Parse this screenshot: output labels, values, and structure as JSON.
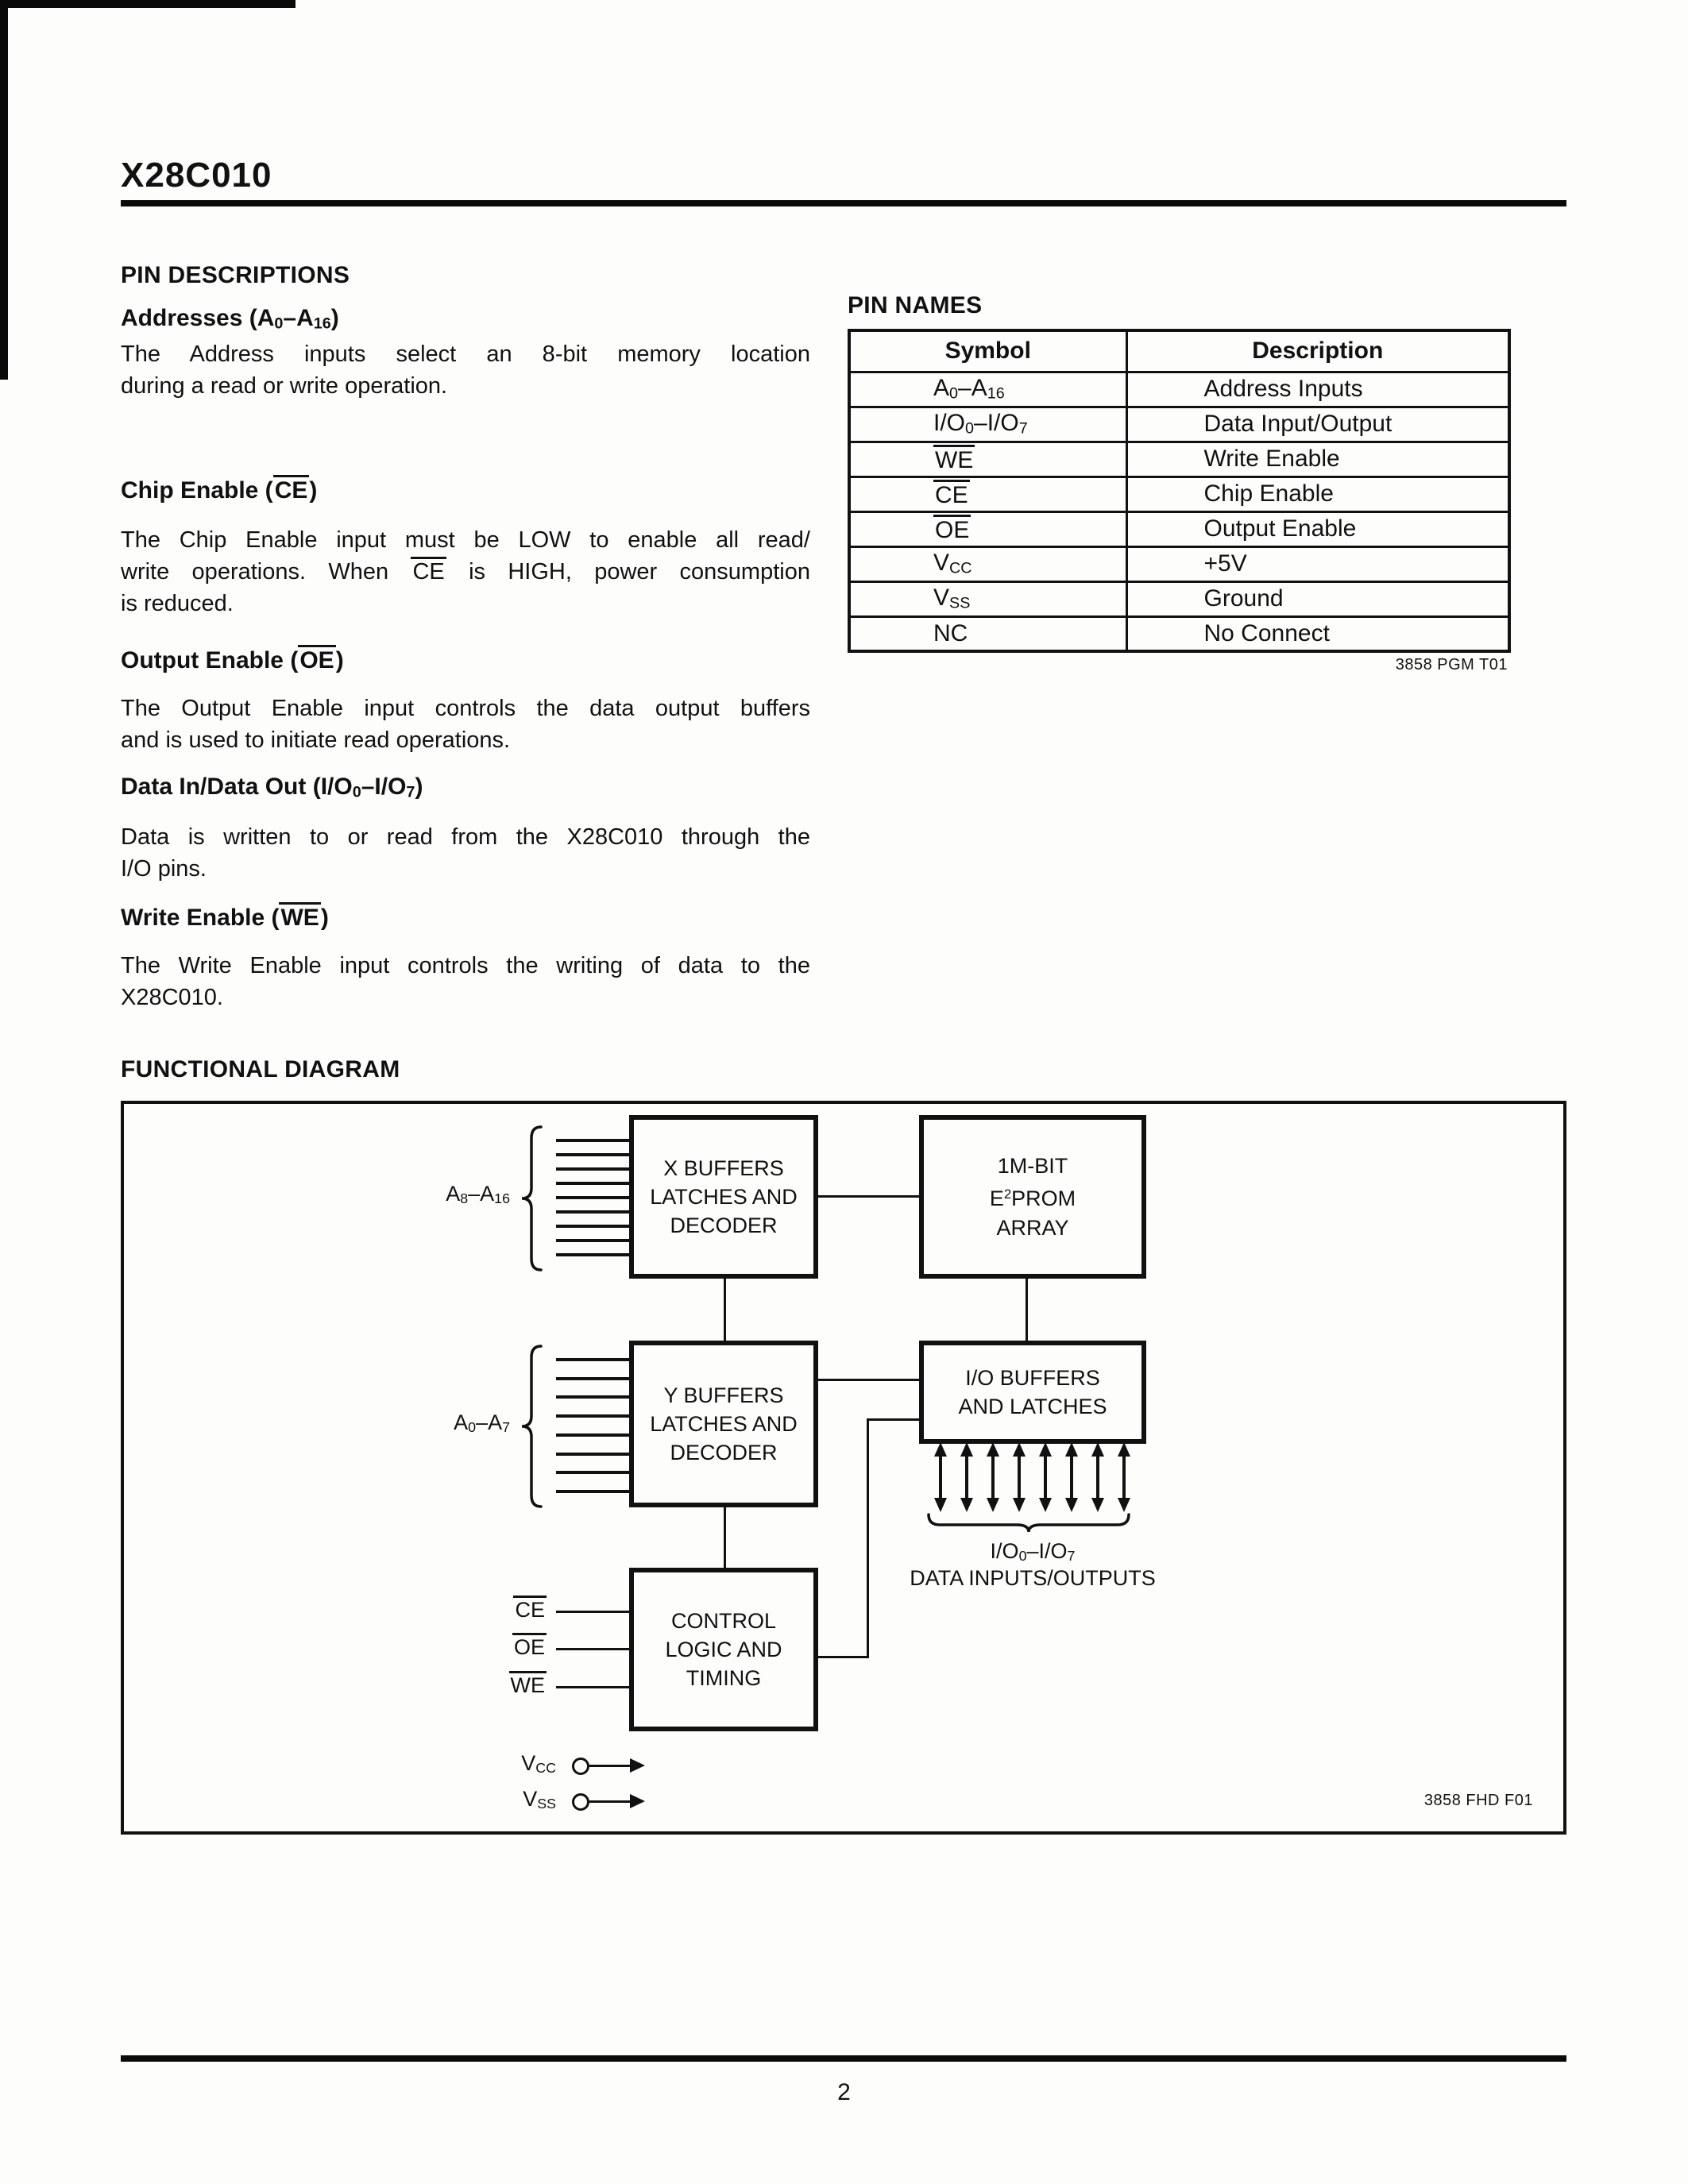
{
  "page": {
    "title": "X28C010",
    "number": "2"
  },
  "pin_descriptions": {
    "heading": "PIN DESCRIPTIONS",
    "sections": [
      {
        "heading": "Addresses (A~0~–A~16~)",
        "lines": [
          "The Address inputs select an 8-bit memory location",
          "during a read or write operation."
        ]
      },
      {
        "heading": "Chip Enable (^CE^)",
        "lines": [
          "The Chip Enable input must be LOW to enable all read/",
          "write operations. When ^CE^ is HIGH, power consumption",
          "is reduced."
        ]
      },
      {
        "heading": "Output Enable (^OE^)",
        "lines": [
          "The Output Enable input controls the data output buffers",
          "and is used to initiate read operations."
        ]
      },
      {
        "heading": "Data In/Data Out (I/O~0~–I/O~7~)",
        "lines": [
          "Data is written to or read from the X28C010 through the",
          "I/O pins."
        ]
      },
      {
        "heading": "Write Enable (^WE^)",
        "lines": [
          "The Write Enable input controls the writing of data to the",
          "X28C010."
        ]
      }
    ]
  },
  "pin_names": {
    "heading": "PIN NAMES",
    "table": {
      "columns": [
        "Symbol",
        "Description"
      ],
      "rows": [
        [
          "A~0~–A~16~",
          "Address Inputs"
        ],
        [
          "I/O~0~–I/O~7~",
          "Data Input/Output"
        ],
        [
          "^WE^",
          "Write Enable"
        ],
        [
          "^CE^",
          "Chip Enable"
        ],
        [
          "^OE^",
          "Output Enable"
        ],
        [
          "V~CC~",
          "+5V"
        ],
        [
          "V~SS~",
          "Ground"
        ],
        [
          "NC",
          "No Connect"
        ]
      ]
    },
    "caption": "3858 PGM T01"
  },
  "functional_diagram": {
    "heading": "FUNCTIONAL DIAGRAM",
    "blocks": {
      "x_buffers": {
        "lines": [
          "X BUFFERS",
          "LATCHES AND",
          "DECODER"
        ]
      },
      "eeprom_array": {
        "lines": [
          "1M-BIT",
          "E²PROM",
          "ARRAY"
        ]
      },
      "y_buffers": {
        "lines": [
          "Y BUFFERS",
          "LATCHES AND",
          "DECODER"
        ]
      },
      "io_buffers": {
        "lines": [
          "I/O BUFFERS",
          "AND LATCHES"
        ]
      },
      "control_logic": {
        "lines": [
          "CONTROL",
          "LOGIC AND",
          "TIMING"
        ]
      }
    },
    "labels": {
      "address_high": "A~8~–A~16~",
      "address_low": "A~0~–A~7~",
      "ce": "^CE^",
      "oe": "^OE^",
      "we": "^WE^",
      "vcc": "V~CC~",
      "vss": "V~SS~",
      "io_range": "I/O~0~–I/O~7~",
      "io_caption": "DATA INPUTS/OUTPUTS",
      "figure_ref": "3858 FHD F01"
    },
    "bus_counts": {
      "address_high": 9,
      "address_low": 8,
      "io_arrows": 8
    }
  }
}
